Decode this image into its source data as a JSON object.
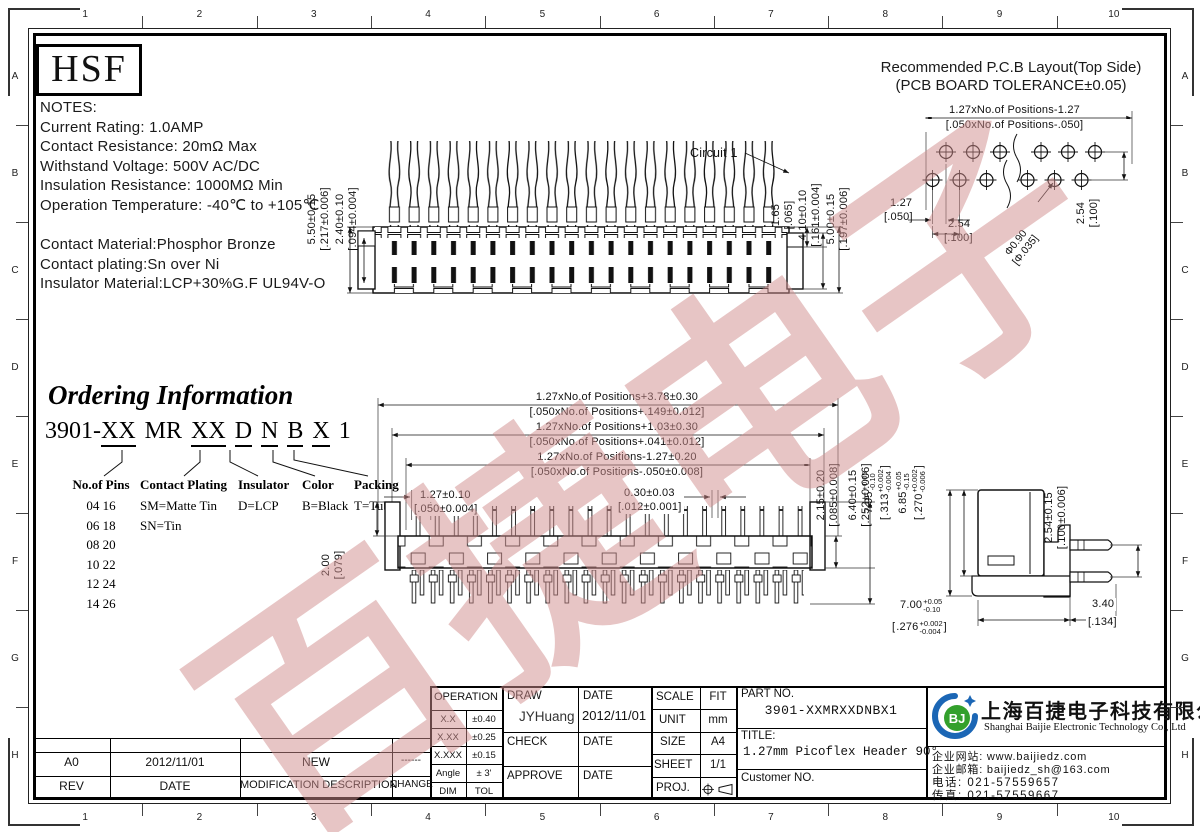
{
  "frame": {
    "top_numbers": [
      "1",
      "2",
      "3",
      "4",
      "5",
      "6",
      "7",
      "8",
      "9",
      "10"
    ],
    "bottom_numbers": [
      "1",
      "2",
      "3",
      "4",
      "5",
      "6",
      "7",
      "8",
      "9",
      "10"
    ],
    "left_letters": [
      "A",
      "B",
      "C",
      "D",
      "E",
      "F",
      "G",
      "H"
    ],
    "right_letters": [
      "A",
      "B",
      "C",
      "D",
      "E",
      "F",
      "G",
      "H"
    ]
  },
  "hsf_logo": "HSF",
  "watermark": {
    "text": "百捷电子",
    "color": "#d08d8d"
  },
  "notes": {
    "title": "NOTES:",
    "line1": "Current Rating: 1.0AMP",
    "line2": "Contact Resistance: 20mΩ Max",
    "line3": "Withstand Voltage: 500V AC/DC",
    "line4": "Insulation Resistance: 1000MΩ Min",
    "line5": "Operation Temperature: -40℃ to +105℃",
    "mat1": "Contact Material:Phosphor Bronze",
    "mat2": "Contact plating:Sn over Ni",
    "mat3": "Insulator Material:LCP+30%G.F UL94V-O"
  },
  "pcb": {
    "title1": "Recommended P.C.B Layout(Top Side)",
    "title2": "(PCB BOARD TOLERANCE±0.05)",
    "span_mm": "1.27xNo.of Positions-1.27",
    "span_in": "[.050xNo.of Positions-.050]",
    "pitch_mm": "1.27",
    "pitch_in": "[.050]",
    "pitch2_mm": "2.54",
    "pitch2_in": "[.100]",
    "row_mm": "2.54",
    "row_in": "[.100]",
    "hole_mm": "Φ0.90",
    "hole_in": "[Φ.035]"
  },
  "topview": {
    "circuit": "Circuit 1",
    "total_mm": "5.50±0.15",
    "total_in": "[.217±0.006]",
    "body_mm": "2.40±0.10",
    "body_in": "[.094±0.004]",
    "d1_mm": "1.65",
    "d1_in": "[.065]",
    "d2_mm": "4.10±0.10",
    "d2_in": "[.161±0.004]",
    "d3_mm": "5.00±0.15",
    "d3_in": "[.197±0.006]"
  },
  "midview": {
    "w1_mm": "1.27xNo.of Positions+3.78±0.30",
    "w1_in": "[.050xNo.of Positions+.149±0.012]",
    "w2_mm": "1.27xNo.of Positions+1.03±0.30",
    "w2_in": "[.050xNo.of Positions+.041±0.012]",
    "w3_mm": "1.27xNo.of Positions-1.27±0.20",
    "w3_in": "[.050xNo.of Positions-.050±0.008]",
    "pitch_mm": "1.27±0.10",
    "pitch_in": "[.050±0.004]",
    "pin_mm": "0.30±0.03",
    "pin_in": "[.012±0.001]",
    "tab_mm": "2.00",
    "tab_in": "[.079]",
    "h1_mm": "2.15±0.20",
    "h1_in": "[.085±0.008]",
    "h2_mm": "6.40±0.15",
    "h2_in": "[.252±0.006]"
  },
  "sideview": {
    "h1_mm": "7.95",
    "h1_mm_p": "+0.05",
    "h1_mm_m": "-0.10",
    "h1_in": ".313",
    "h1_in_p": "+0.002",
    "h1_in_m": "-0.004",
    "h2_mm": "6.85",
    "h2_mm_p": "+0.05",
    "h2_mm_m": "-0.15",
    "h2_in": ".270",
    "h2_in_p": "+0.002",
    "h2_in_m": "-0.006",
    "pitch_mm": "2.54±0.15",
    "pitch_in": "[.100±0.006]",
    "depth_mm": "7.00",
    "depth_mm_p": "+0.05",
    "depth_mm_m": "-0.10",
    "depth_in": ".276",
    "depth_in_p": "+0.002",
    "depth_in_m": "-0.004",
    "tail_mm": "3.40",
    "tail_in": "[.134]"
  },
  "ordering": {
    "title": "Ordering Information",
    "seg1": "3901-",
    "seg2": "XX",
    "seg3": "MR",
    "seg4": "XX",
    "seg5": "D",
    "seg6": "N",
    "seg7": "B",
    "seg8": "X",
    "seg9": "1",
    "col1_header": "No.of Pins",
    "col1_values": "04  16\n06  18\n08  20\n10  22\n12  24\n14  26",
    "col2_header": "Contact Plating",
    "col2_values": "SM=Matte Tin\nSN=Tin",
    "col3_header": "Insulator",
    "col3_values": "D=LCP",
    "col4_header": "Color",
    "col4_values": "B=Black",
    "col5_header": "Packing",
    "col5_values": "T=Tube"
  },
  "titleblock": {
    "tol_header": "OPERATION",
    "tol_r1c1": "X.X",
    "tol_r1c2": "±0.40",
    "tol_r2c1": "X.XX",
    "tol_r2c2": "±0.25",
    "tol_r3c1": "X.XXX",
    "tol_r3c2": "±0.15",
    "tol_r4c1": "Angle",
    "tol_r4c2": "± 3'",
    "tol_r5c1": "DIM",
    "tol_r5c2": "TOL",
    "draw_label": "DRAW",
    "draw_name": "JYHuang",
    "date_label1": "DATE",
    "draw_date": "2012/11/01",
    "check_label": "CHECK",
    "date_label2": "DATE",
    "approve_label": "APPROVE",
    "date_label3": "DATE",
    "scale_label": "SCALE",
    "scale_value": "FIT",
    "unit_label": "UNIT",
    "unit_value": "mm",
    "size_label": "SIZE",
    "size_value": "A4",
    "sheet_label": "SHEET",
    "sheet_value": "1/1",
    "proj_label": "PROJ.",
    "part_no_label": "PART NO.",
    "part_no": "3901-XXMRXXDNBX1",
    "title_label": "TITLE:",
    "title_value": "1.27mm Picoflex Header 90°",
    "customer_label": "Customer NO.",
    "rev_value": "A0",
    "rev_date": "2012/11/01",
    "rev_desc": "NEW",
    "rev_change": "------",
    "rev_h1": "REV",
    "rev_h2": "DATE",
    "rev_h3": "MODIFICATION  DESCRIPTION",
    "rev_h4": "CHANGE"
  },
  "company": {
    "logo_text": "BJ",
    "name_cn": "上海百捷电子科技有限公司",
    "name_en": "Shanghai Baijie Electronic Technology Co., Ltd",
    "website": "企业网站: www.baijiedz.com",
    "email": "企业邮箱: baijiedz_sh@163.com",
    "tel": "电话: 021-57559657",
    "fax": "传真: 021-57559667"
  }
}
